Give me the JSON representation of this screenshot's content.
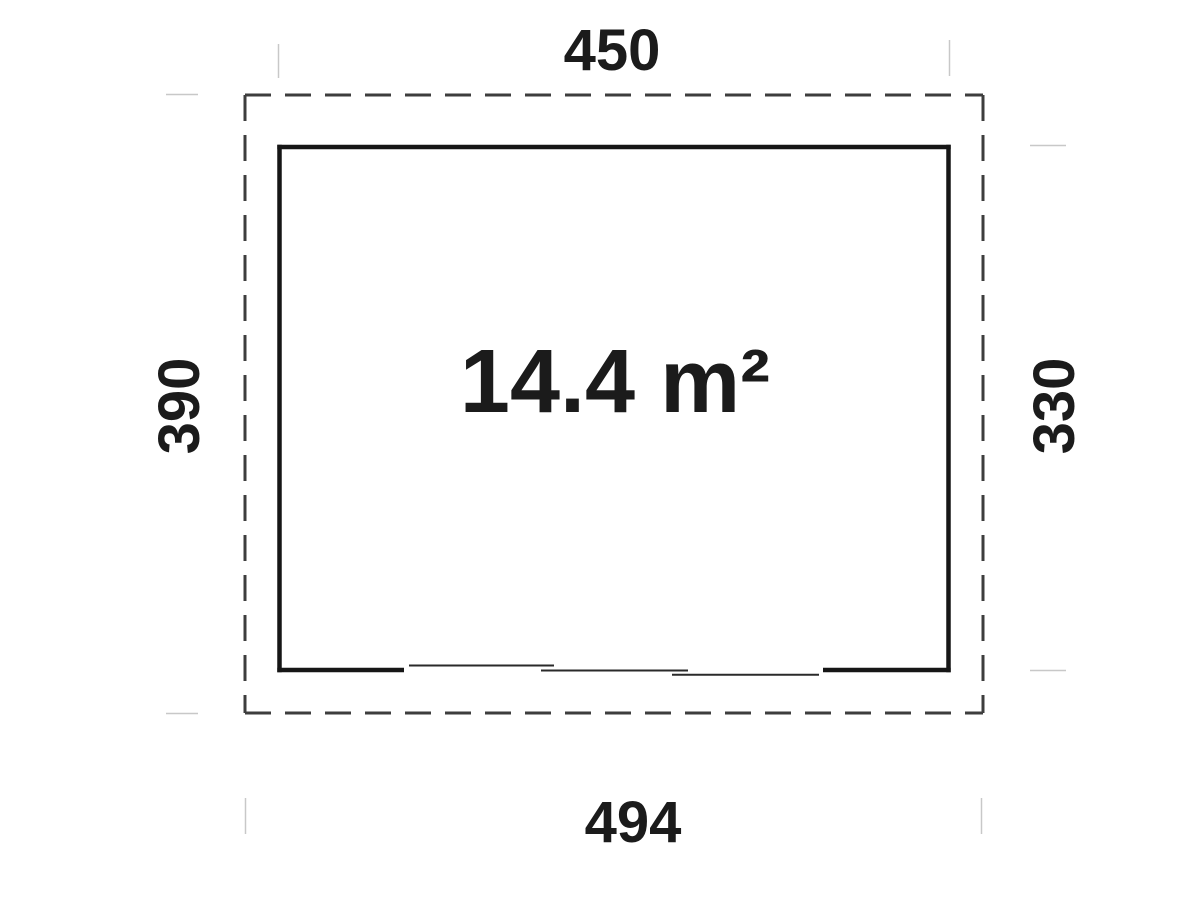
{
  "diagram": {
    "type": "floor-plan",
    "area_label": "14.4 m²",
    "dimensions": {
      "top": "450",
      "left": "390",
      "right": "330",
      "bottom": "494"
    },
    "features": {
      "outer_outline": "dashed footprint rectangle",
      "inner_outline": "solid wall rectangle",
      "door": "triple sliding door opening in bottom wall"
    },
    "colors": {
      "wall": "#161616",
      "dashed_outline": "#3d3d3d",
      "door_panel": "#2a2a2a",
      "tick": "#c8c8c8",
      "background": "#ffffff",
      "text": "#1b1b1b"
    }
  }
}
